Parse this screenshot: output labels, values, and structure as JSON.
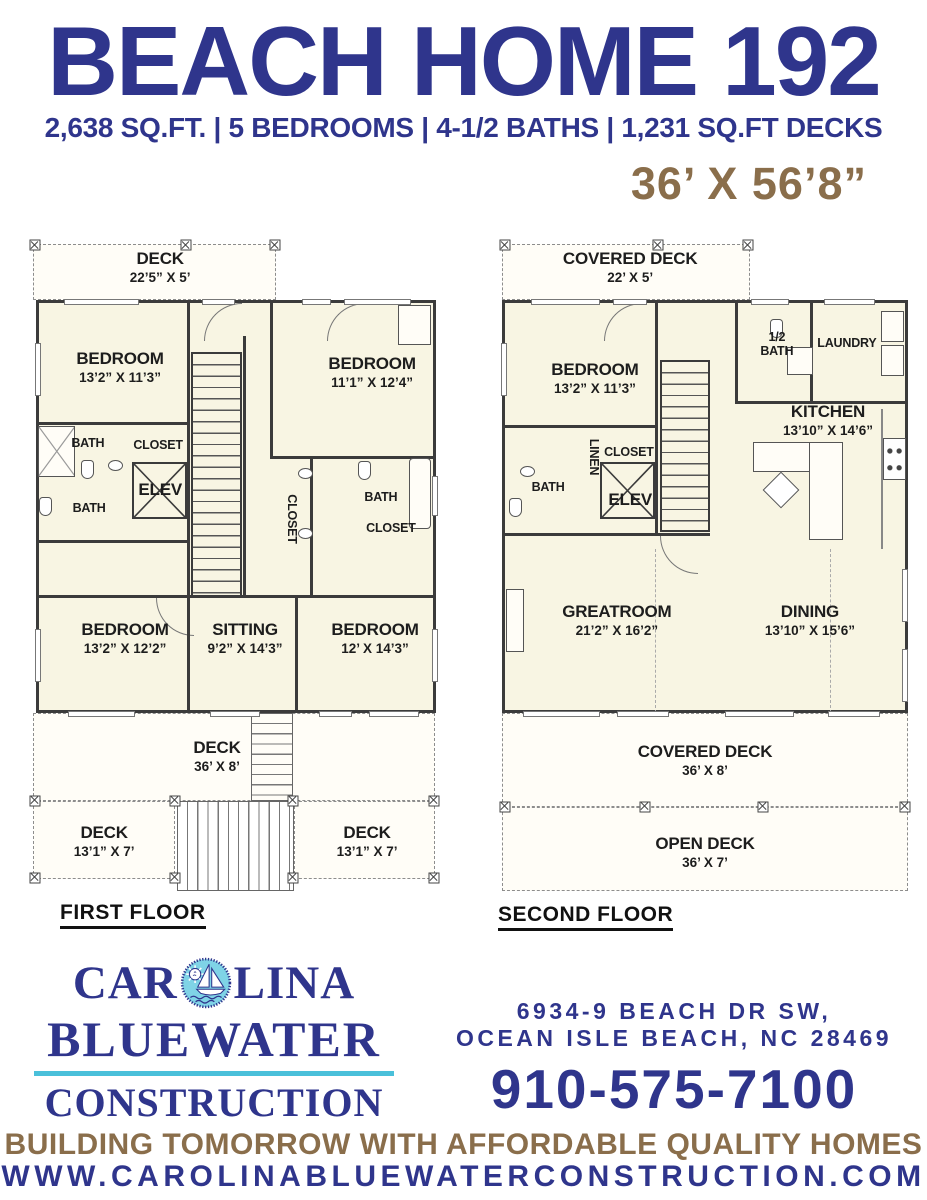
{
  "header": {
    "title": "BEACH HOME 192",
    "specs": "2,638 SQ.FT. | 5 BEDROOMS | 4-1/2 BATHS | 1,231 SQ.FT DECKS",
    "dimensions": "36’ X 56’8”"
  },
  "first_floor": {
    "label": "FIRST FLOOR",
    "deck_top": {
      "name": "DECK",
      "dims": "22’5” X 5’"
    },
    "bedroom_tl": {
      "name": "BEDROOM",
      "dims": "13’2” X 11’3”"
    },
    "bedroom_tr": {
      "name": "BEDROOM",
      "dims": "11’1” X 12’4”"
    },
    "bath_upper": "BATH",
    "closet_upper": "CLOSET",
    "elev_label": "ELEV",
    "closet_hall": "CLOSET",
    "bath_lower": "BATH",
    "bath_right": "BATH",
    "closet_right": "CLOSET",
    "bedroom_bl": {
      "name": "BEDROOM",
      "dims": "13’2” X 12’2”"
    },
    "sitting": {
      "name": "SITTING",
      "dims": "9’2” X 14’3”"
    },
    "bedroom_br": {
      "name": "BEDROOM",
      "dims": "12’ X 14’3”"
    },
    "deck_rear": {
      "name": "DECK",
      "dims": "36’ X 8’"
    },
    "deck_left": {
      "name": "DECK",
      "dims": "13’1” X 7’"
    },
    "deck_right": {
      "name": "DECK",
      "dims": "13’1” X 7’"
    }
  },
  "second_floor": {
    "label": "SECOND FLOOR",
    "deck_top": {
      "name": "COVERED DECK",
      "dims": "22’ X 5’"
    },
    "bedroom": {
      "name": "BEDROOM",
      "dims": "13’2” X 11’3”"
    },
    "half_bath": {
      "line1": "1/2",
      "line2": "BATH"
    },
    "laundry": "LAUNDRY",
    "kitchen": {
      "name": "KITCHEN",
      "dims": "13’10” X 14’6”"
    },
    "bath": "BATH",
    "linen": "LINEN",
    "closet": "CLOSET",
    "elev_label": "ELEV",
    "greatroom": {
      "name": "GREATROOM",
      "dims": "21’2” X 16’2”"
    },
    "dining": {
      "name": "DINING",
      "dims": "13’10” X 15’6”"
    },
    "covered_deck": {
      "name": "COVERED DECK",
      "dims": "36’ X 8’"
    },
    "open_deck": {
      "name": "OPEN DECK",
      "dims": "36’ X 7’"
    }
  },
  "footer": {
    "logo": {
      "part1": "CAR",
      "part2": "LINA",
      "line2": "BLUEWATER",
      "line3": "CONSTRUCTION",
      "badge_icon": "sun-sailboat-circle"
    },
    "address_line1": "6934-9 BEACH DR SW,",
    "address_line2": "OCEAN ISLE BEACH, NC 28469",
    "phone": "910-575-7100",
    "tagline": "BUILDING TOMORROW WITH AFFORDABLE QUALITY HOMES",
    "website": "WWW.CAROLINABLUEWATERCONSTRUCTION.COM"
  },
  "colors": {
    "navy": "#2f358c",
    "brown": "#8a6e4b",
    "cream": "#f8f5e3",
    "logo_blue": "#7fd3e6",
    "rule_cyan": "#4ac0da"
  }
}
